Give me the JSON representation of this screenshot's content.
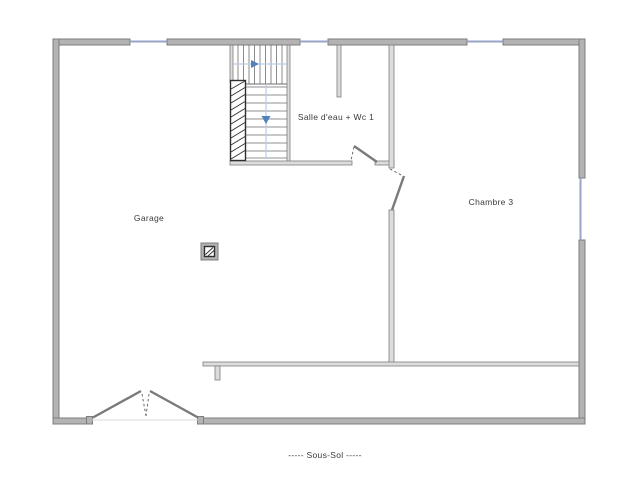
{
  "plan": {
    "floor_title": "-----  Sous-Sol  -----",
    "rooms": {
      "garage": {
        "label": "Garage"
      },
      "salle_eau": {
        "label": "Salle d'eau + Wc 1"
      },
      "chambre3": {
        "label": "Chambre 3"
      }
    },
    "features": {
      "stairs": "staircase-two-flights",
      "stair_direction_up": "right-arrow",
      "stair_direction_down": "down-arrow",
      "pillar": "hatched-square-post",
      "garage_door": "double-swing-door",
      "windows": "4"
    }
  },
  "colors": {
    "background": "#ffffff",
    "wall_fill": "#b3b3b3",
    "wall_stroke": "#7d7d7d",
    "thin_wall_fill": "#dcdcdc",
    "line": "#6e6e6e",
    "window": "#99a3c7",
    "stair_guide": "#b9cde5",
    "stair_arrow": "#4f81bd",
    "hatch": "#2f2f2f",
    "text": "#3a3a3a"
  }
}
